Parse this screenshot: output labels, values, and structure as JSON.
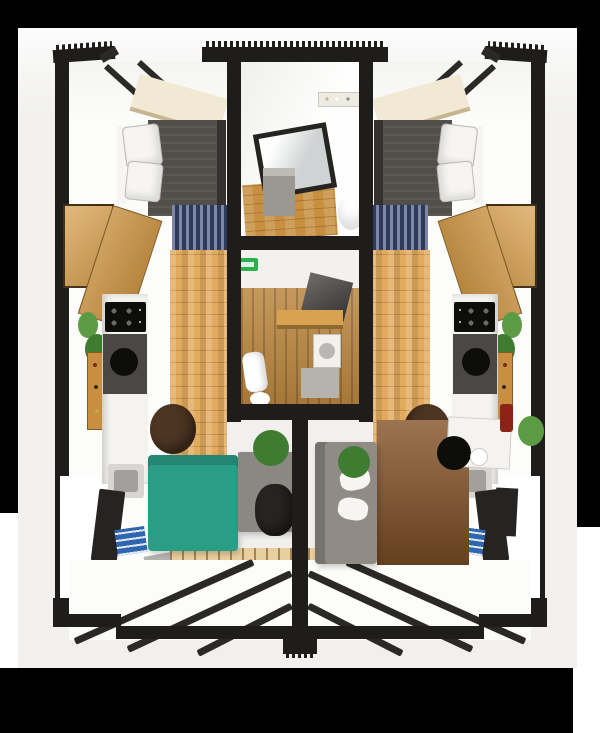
{
  "meta": {
    "description": "3D cutaway dollhouse render of two mirrored studio apartment units flanking a central bathroom (top) and entry hall (middle), each unit with bed, wardrobe, kitchen counter, desk, sofa and glazed balcony; image letterboxed by black bars on white canvas",
    "text_content_visible": "none"
  },
  "palette": {
    "letterbox": "#000000",
    "white": "#ffffff",
    "photo_bg": "#f1f0ee",
    "wall": "#1f1d1b",
    "wall_soft": "#2b2927",
    "room_white": "#fcfcfa",
    "ceiling_cream": "#f1e9d4",
    "wood_light": "#d9a251",
    "wood_mid": "#c78f3f",
    "wood_floor": "#e2ab5e",
    "hall_wood": "#bb873f",
    "duvet_gray": "#514f4a",
    "duvet_dark": "#34322f",
    "pillow_white": "#f6f5f2",
    "rug_navy": "#2e3a5a",
    "rug_navy_light": "#7e88a6",
    "sofa_teal": "#2b9d87",
    "sofa_gray": "#908c85",
    "rug_brown": "#87552a",
    "desk_gray": "#8b8883",
    "chair_dark": "#262422",
    "plant_green": "#3e7c31",
    "plant_light": "#5a9b43",
    "exit_green": "#2db14f",
    "counter_white": "#f4f3ef",
    "appliance_dark": "#4a4846",
    "appliance_black": "#0d0d0c",
    "steel": "#d8d6d2",
    "books_blue": "#2f66ae",
    "mat_gray": "#b5b3ae",
    "threshold_wood": "#e9cf9e",
    "shelf_cream": "#eeebe3",
    "mirror_glass": "#e2e5e5",
    "cabinet_gray": "#9b9791",
    "washer_white": "#f2f1ee",
    "stool_brown": "#4d3523",
    "red_accent": "#8c2318"
  },
  "regions": {
    "units": [
      "left-unit",
      "right-unit"
    ],
    "core": [
      "bathroom",
      "entry-hall"
    ],
    "per_unit": [
      "bedroom",
      "kitchen",
      "living-area",
      "balcony"
    ]
  }
}
